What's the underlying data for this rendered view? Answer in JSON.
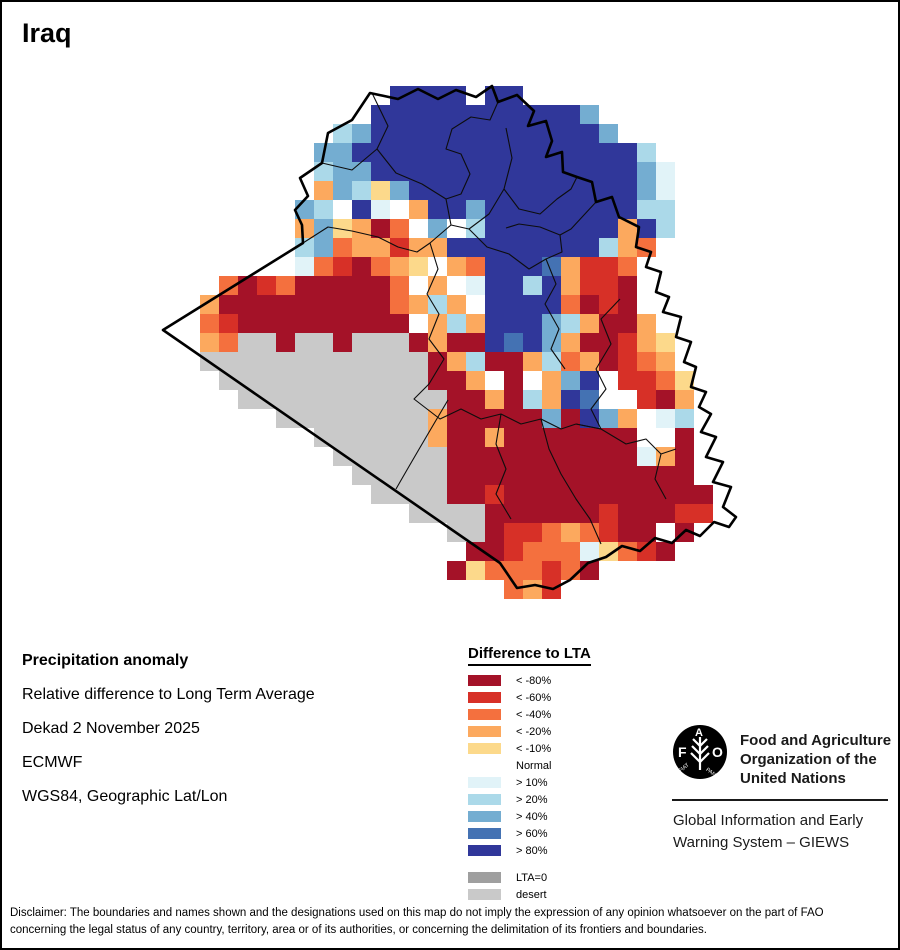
{
  "title": "Iraq",
  "info": {
    "line1": "Precipitation anomaly",
    "line2": "Relative difference to Long Term Average",
    "line3": "Dekad 2 November 2025",
    "line4": "ECMWF",
    "line5": "WGS84, Geographic Lat/Lon"
  },
  "legend": {
    "title": "Difference to LTA",
    "items": [
      {
        "label": "< -80%",
        "color": "#a41228"
      },
      {
        "label": "< -60%",
        "color": "#d73027"
      },
      {
        "label": "< -40%",
        "color": "#f4703e"
      },
      {
        "label": "< -20%",
        "color": "#fca95e"
      },
      {
        "label": "< -10%",
        "color": "#fcd98b"
      },
      {
        "label": "Normal",
        "color": "#ffffff"
      },
      {
        "label": "> 10%",
        "color": "#e1f3f8"
      },
      {
        "label": "> 20%",
        "color": "#abd9e9"
      },
      {
        "label": "> 40%",
        "color": "#74add1"
      },
      {
        "label": "> 60%",
        "color": "#4472b3"
      },
      {
        "label": "> 80%",
        "color": "#30379a"
      }
    ],
    "extra_items": [
      {
        "label": "LTA=0",
        "color": "#9f9f9f"
      },
      {
        "label": "desert",
        "color": "#c9c9c9"
      }
    ]
  },
  "map": {
    "origin_x": 162,
    "origin_y": 86,
    "cell": 19,
    "palette": {
      "K": "#a41228",
      "R": "#d73027",
      "O": "#f4703e",
      "o": "#fca95e",
      "y": "#fcd98b",
      "W": "#ffffff",
      "p": "#e1f3f8",
      "q": "#abd9e9",
      "s": "#74add1",
      "t": "#4472b3",
      "B": "#30379a",
      "G": "#9f9f9f",
      "D": "#c9c9c9"
    },
    "rows": [
      "............BBBBWBB...........",
      "...........BBBBBBBBBBBs.......",
      ".........qsBBBBBBBBBBBBs......",
      "........ssBBBBBBBBBBBBBBBq....",
      "........qssBBBBBBBBBBBBBBsp...",
      "........osqysBBBBBBBBBBBBsp...",
      ".......sqWBpWoBBsBBBBBBBBqq...",
      ".......osyoKOWsWqBBBBBBBoBq...",
      ".......qsOooRooBBBBBBBBqoO....",
      ".......pORKOoyWoOBBBtoRRO.....",
      "...OKROKKKKKOWoWpBBqBoRRK.....",
      "..oKKKKKKKKKOoqoWBBBBOKRK.....",
      ".WORKKKKKKKKKWoqoBBBsqoKKo....",
      ".WoODDKDDKDDDKoKKBtBsoKKRoy...",
      "..DDDDDDDDDDDDKoqKKoqOoKROo...",
      "...DDDDDDDDDDDKKoWKWosBWRROy..",
      "....DDDDDDDDDDDKKoKqoBtWWRKo..",
      "......DDDDDDDDoKKKKKsKBsoWpq..",
      "........DDDDDDoKKoKKKKKKKWWK..",
      ".........DDDDDDKKKKKKKKKKpoK..",
      "..........DDDDDKKKKKKKKKKKKK..",
      "...........DDDDKKRKKKKKKKKKKK.",
      ".............DDDDKKKKKKRKKKRR.",
      "...............DDKRROoORKKWK..",
      "................KKROOOpyORK...",
      "...............KyOOOROK.......",
      "..................OoR........."
    ]
  },
  "fao": {
    "org_line1": "Food and Agriculture",
    "org_line2": "Organization of the",
    "org_line3": "United Nations",
    "giews_line1": "Global Information and Early",
    "giews_line2": "Warning System – GIEWS",
    "logo_letter_f": "F",
    "logo_letter_a": "A",
    "logo_letter_o": "O",
    "logo_fiat": "FIAT",
    "logo_panis": "PANIS"
  },
  "disclaimer": {
    "line1": "Disclaimer: The boundaries and names shown and the designations used on this map do not imply the expression of any opinion whatsoever on the part of FAO",
    "line2": "concerning the legal status of any country, territory, area or of its authorities, or concerning the delimitation of its frontiers and boundaries."
  }
}
